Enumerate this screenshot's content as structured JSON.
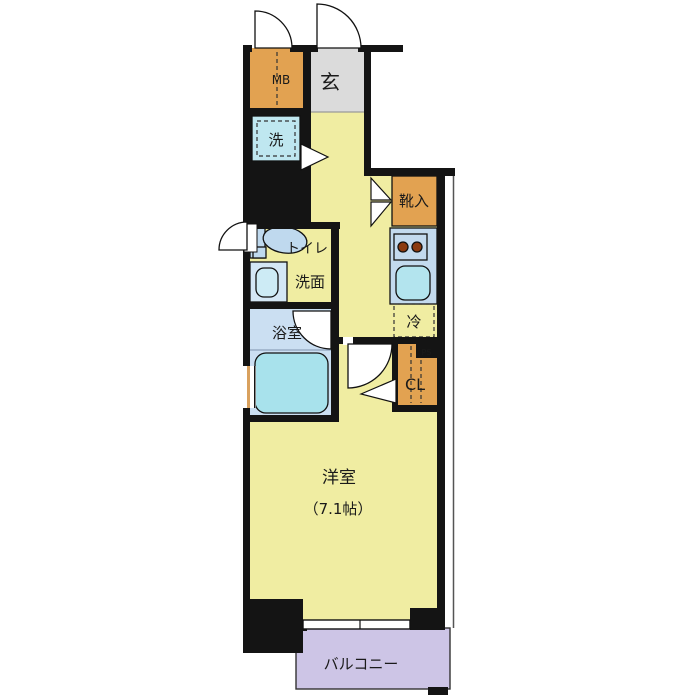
{
  "plan": {
    "type": "apartment-floor-plan",
    "labels": {
      "meter_box": "MB",
      "entrance": "玄",
      "washer": "洗",
      "shoe_storage": "靴入",
      "toilet": "トイレ",
      "washroom": "洗面",
      "bathroom": "浴室",
      "refrigerator": "冷",
      "closet": "CL",
      "pipe_space": "PS",
      "western_room": "洋室",
      "western_room_size": "（7.1帖）",
      "balcony": "バルコニー"
    }
  },
  "colors": {
    "floor": "#F0EDA2",
    "wall": "#141414",
    "entrance_floor": "#DBDBDB",
    "storage_orange": "#E2A251",
    "washer": "#BFE7F0",
    "bath_floor": "#CBDFF2",
    "bathtub": "#A8E2EC",
    "fixture": "#BFD9EE",
    "basin_box": "#D4E7F5",
    "basin": "#CDEBF5",
    "counter": "#C3DAEE",
    "kitchen_sink": "#B3E4EE",
    "burner": "#8B3A10",
    "balcony": "#CDC5E6",
    "ps_label": "#D8A060",
    "window_frame": "#D9A15E"
  }
}
